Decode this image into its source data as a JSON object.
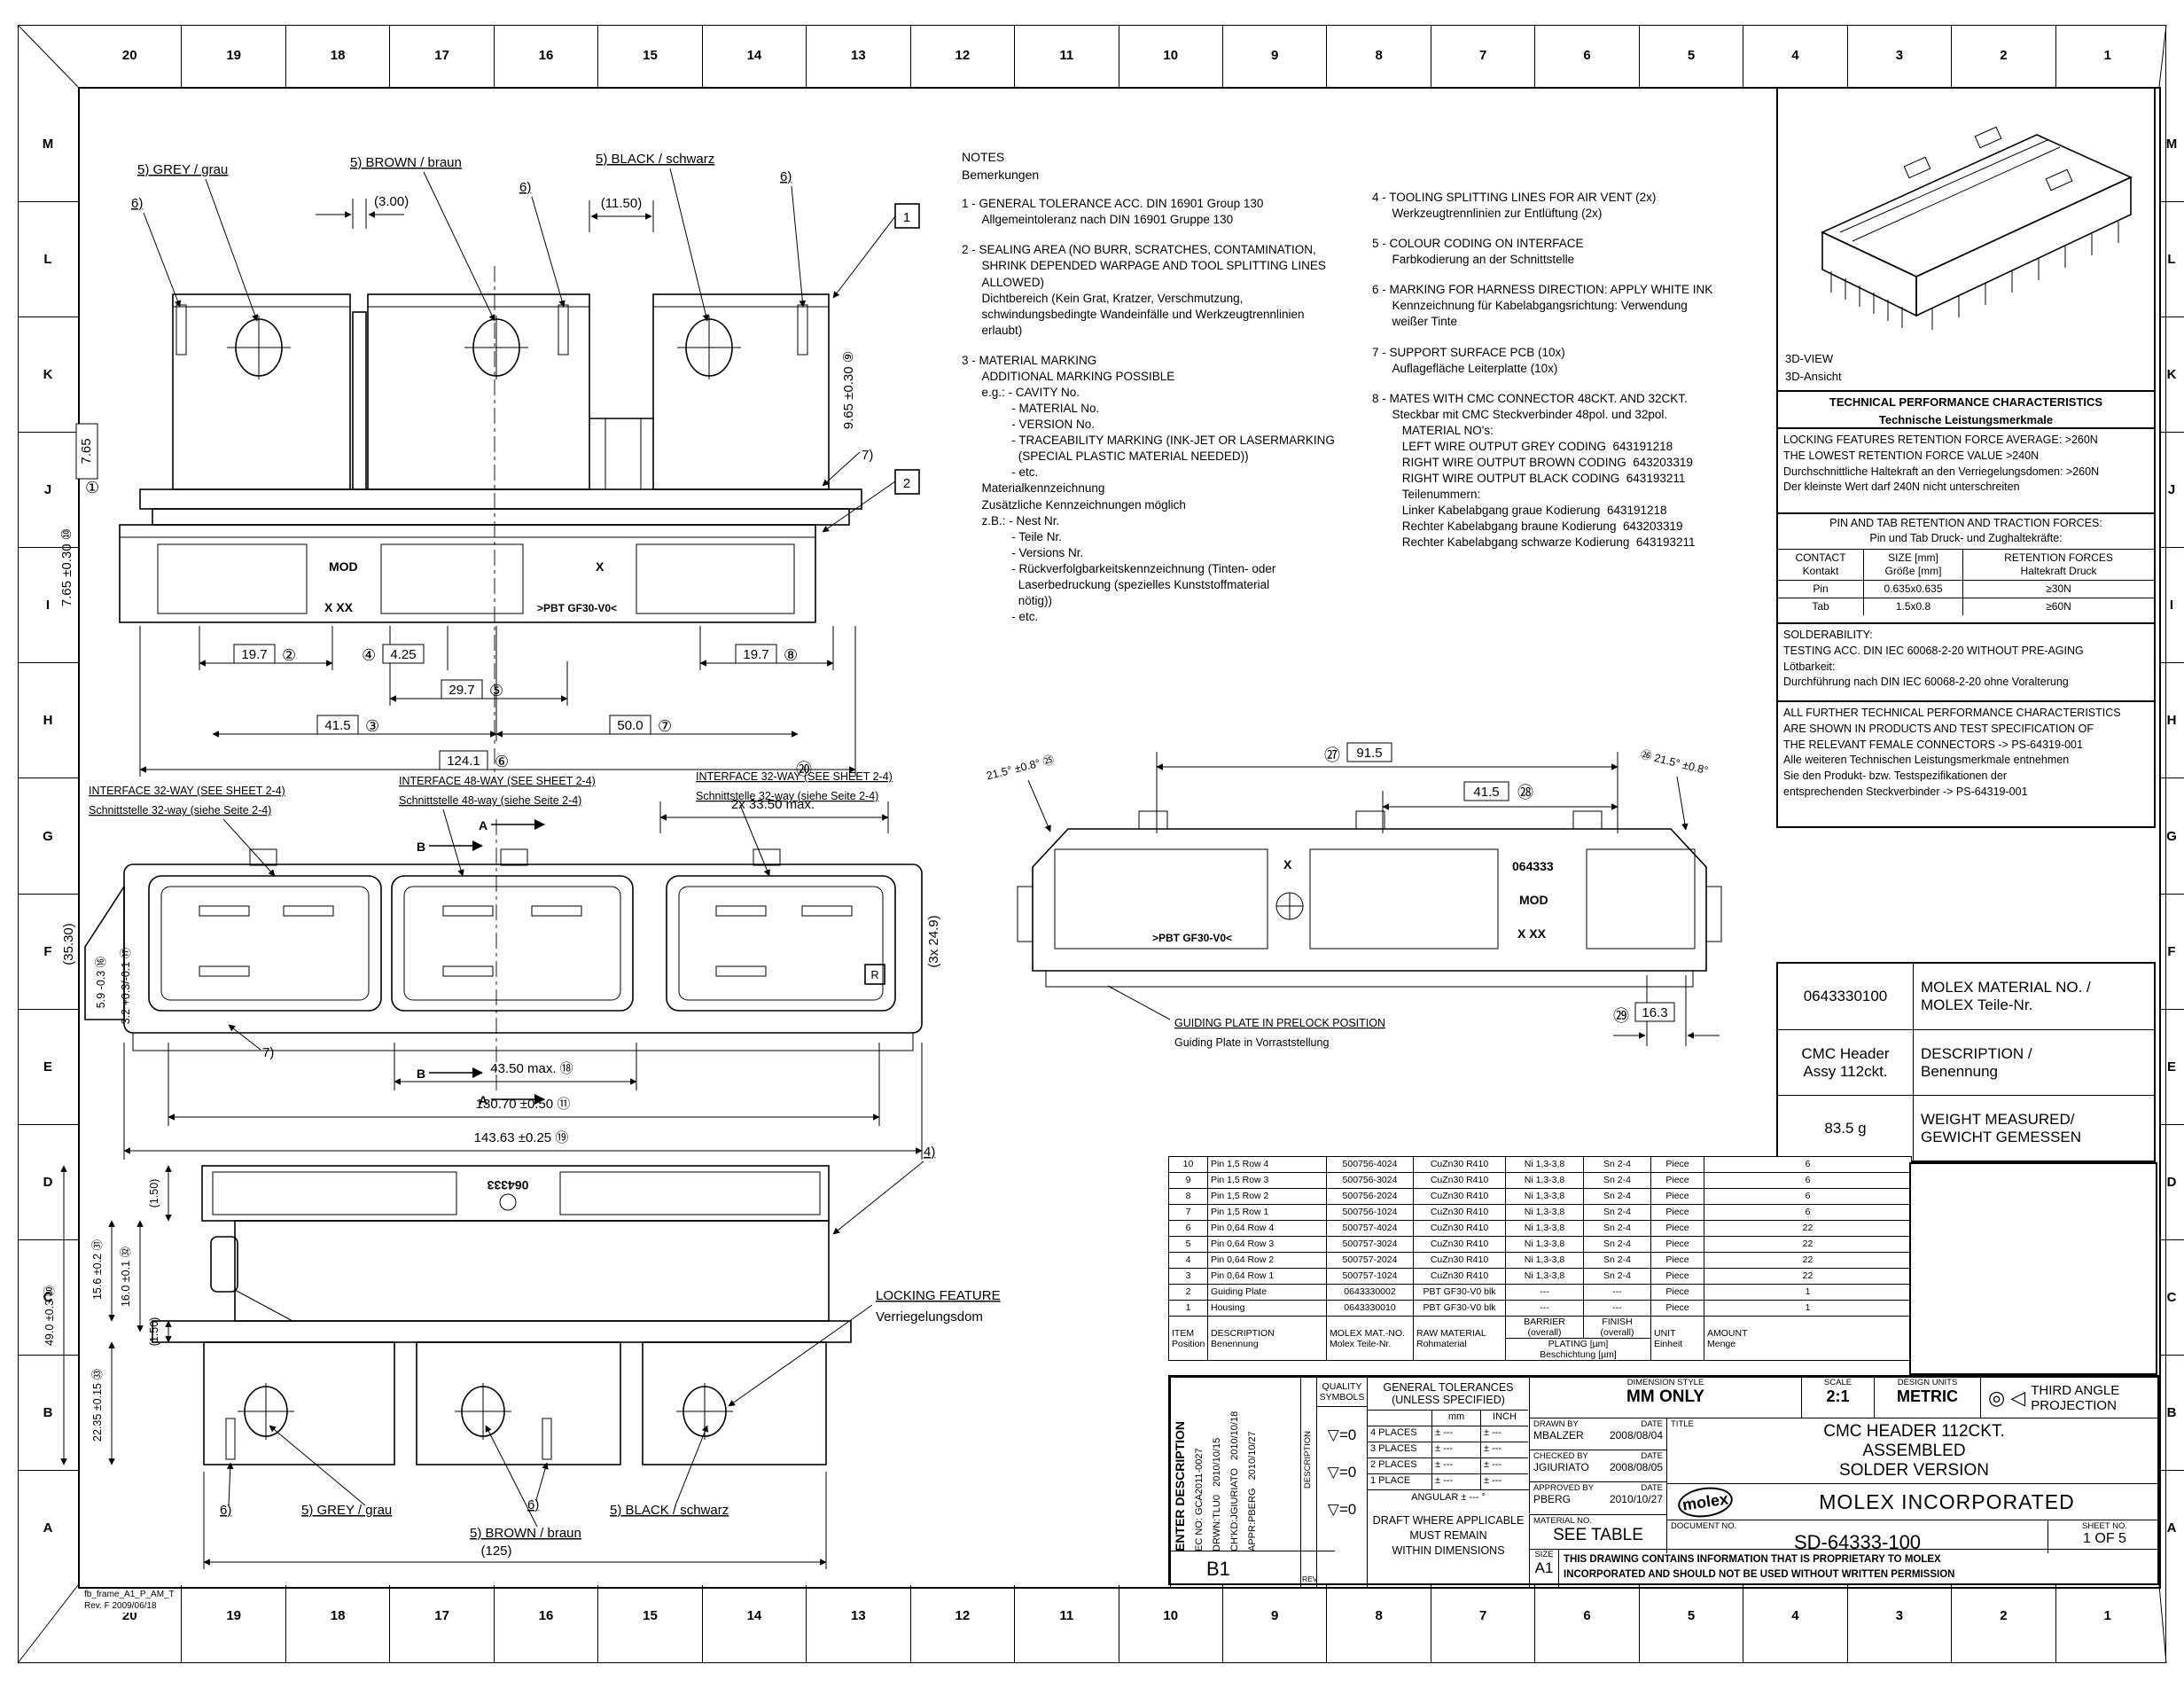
{
  "frame": {
    "cols": [
      "20",
      "19",
      "18",
      "17",
      "16",
      "15",
      "14",
      "13",
      "12",
      "11",
      "10",
      "9",
      "8",
      "7",
      "6",
      "5",
      "4",
      "3",
      "2",
      "1"
    ],
    "rows": [
      "M",
      "L",
      "K",
      "J",
      "I",
      "H",
      "G",
      "F",
      "E",
      "D",
      "C",
      "B",
      "A"
    ],
    "id": "fb_frame_A1_P_AM_T",
    "rev": "Rev. F 2009/06/18"
  },
  "notes": {
    "title": "NOTES\nBemerkungen",
    "n1": "1 - GENERAL TOLERANCE ACC. DIN 16901 Group 130\n      Allgemeintoleranz nach DIN 16901 Gruppe 130",
    "n2": "2 - SEALING AREA (NO BURR, SCRATCHES, CONTAMINATION,\n      SHRINK DEPENDED WARPAGE AND TOOL SPLITTING LINES\n      ALLOWED)\n      Dichtbereich (Kein Grat, Kratzer, Verschmutzung,\n      schwindungsbedingte Wandeinfälle und Werkzeugtrennlinien\n      erlaubt)",
    "n3": "3 - MATERIAL MARKING\n      ADDITIONAL MARKING POSSIBLE\n      e.g.: - CAVITY No.\n               - MATERIAL No.\n               - VERSION No.\n               - TRACEABILITY MARKING (INK-JET OR LASERMARKING\n                 (SPECIAL PLASTIC MATERIAL NEEDED))\n               - etc.\n      Materialkennzeichnung\n      Zusätzliche Kennzeichnungen möglich\n      z.B.: - Nest Nr.\n               - Teile Nr.\n               - Versions Nr.\n               - Rückverfolgbarkeitskennzeichnung (Tinten- oder\n                 Laserbedruckung (spezielles Kunststoffmaterial\n                 nötig))\n               - etc.",
    "n4": "4 - TOOLING SPLITTING LINES FOR AIR VENT (2x)\n      Werkzeugtrennlinien zur Entlüftung (2x)",
    "n5": "5 - COLOUR CODING ON INTERFACE\n      Farbkodierung an der Schnittstelle",
    "n6": "6 - MARKING FOR HARNESS DIRECTION: APPLY WHITE INK\n      Kennzeichnung für Kabelabgangsrichtung: Verwendung\n      weißer Tinte",
    "n7": "7 - SUPPORT SURFACE PCB (10x)\n      Auflagefläche Leiterplatte (10x)",
    "n8": "8 - MATES WITH CMC CONNECTOR 48CKT. AND 32CKT.\n      Steckbar mit CMC Steckverbinder 48pol. und 32pol.\n         MATERIAL NO's:\n         LEFT WIRE OUTPUT GREY CODING  643191218\n         RIGHT WIRE OUTPUT BROWN CODING  643203319\n         RIGHT WIRE OUTPUT BLACK CODING  643193211\n         Teilenummern:\n         Linker Kabelabgang graue Kodierung  643191218\n         Rechter Kabelabgang braune Kodierung  643203319\n         Rechter Kabelabgang schwarze Kodierung  643193211"
  },
  "panel": {
    "view3d": "3D-VIEW\n3D-Ansicht",
    "tech_title": "TECHNICAL PERFORMANCE CHARACTERISTICS",
    "tech_title_de": "Technische Leistungsmerkmale",
    "locking": "LOCKING FEATURES RETENTION FORCE AVERAGE: >260N\nTHE LOWEST RETENTION FORCE VALUE >240N\nDurchschnittliche Haltekraft an den Verriegelungsdomen: >260N\nDer kleinste Wert darf 240N nicht unterschreiten",
    "pintab_title": "PIN AND TAB RETENTION AND TRACTION FORCES:\nPin und Tab Druck- und Zughaltekräfte:",
    "tbl": {
      "h1": "CONTACT\nKontakt",
      "h2": "SIZE [mm]\nGröße [mm]",
      "h3": "RETENTION FORCES\nHaltekraft Druck",
      "r1": [
        "Pin",
        "0.635x0.635",
        "≥30N"
      ],
      "r2": [
        "Tab",
        "1.5x0.8",
        "≥60N"
      ]
    },
    "solder": "SOLDERABILITY:\nTESTING ACC. DIN IEC 60068-2-20 WITHOUT PRE-AGING\nLötbarkeit:\nDurchführung nach DIN IEC 60068-2-20 ohne Voralterung",
    "further": "ALL FURTHER TECHNICAL PERFORMANCE CHARACTERISTICS\nARE SHOWN IN PRODUCTS AND TEST SPECIFICATION OF\nTHE RELEVANT FEMALE CONNECTORS -> PS-64319-001\nAlle weiteren Technischen Leistungsmerkmale entnehmen\nSie den Produkt- bzw. Testspezifikationen der\nentsprechenden Steckverbinder -> PS-64319-001"
  },
  "mat": {
    "no": "0643330100",
    "no_l": "MOLEX MATERIAL NO. /\nMOLEX Teile-Nr.",
    "desc": "CMC Header\nAssy 112ckt.",
    "desc_l": "DESCRIPTION /\nBenennung",
    "wt": "83.5 g",
    "wt_l": "WEIGHT MEASURED/\nGEWICHT GEMESSEN"
  },
  "bom": {
    "rows": [
      [
        "10",
        "Pin 1,5 Row 4",
        "500756-4024",
        "CuZn30 R410",
        "Ni 1,3-3,8",
        "Sn 2-4",
        "Piece",
        "6"
      ],
      [
        "9",
        "Pin 1,5 Row 3",
        "500756-3024",
        "CuZn30 R410",
        "Ni 1,3-3,8",
        "Sn 2-4",
        "Piece",
        "6"
      ],
      [
        "8",
        "Pin 1,5 Row 2",
        "500756-2024",
        "CuZn30 R410",
        "Ni 1,3-3,8",
        "Sn 2-4",
        "Piece",
        "6"
      ],
      [
        "7",
        "Pin 1,5 Row 1",
        "500756-1024",
        "CuZn30 R410",
        "Ni 1,3-3,8",
        "Sn 2-4",
        "Piece",
        "6"
      ],
      [
        "6",
        "Pin 0,64 Row 4",
        "500757-4024",
        "CuZn30 R410",
        "Ni 1,3-3,8",
        "Sn 2-4",
        "Piece",
        "22"
      ],
      [
        "5",
        "Pin 0,64 Row 3",
        "500757-3024",
        "CuZn30 R410",
        "Ni 1,3-3,8",
        "Sn 2-4",
        "Piece",
        "22"
      ],
      [
        "4",
        "Pin 0,64 Row 2",
        "500757-2024",
        "CuZn30 R410",
        "Ni 1,3-3,8",
        "Sn 2-4",
        "Piece",
        "22"
      ],
      [
        "3",
        "Pin 0,64 Row 1",
        "500757-1024",
        "CuZn30 R410",
        "Ni 1,3-3,8",
        "Sn 2-4",
        "Piece",
        "22"
      ],
      [
        "2",
        "Guiding Plate",
        "0643330002",
        "PBT GF30-V0 blk",
        "---",
        "---",
        "Piece",
        "1"
      ],
      [
        "1",
        "Housing",
        "0643330010",
        "PBT GF30-V0 blk",
        "---",
        "---",
        "Piece",
        "1"
      ]
    ],
    "h": {
      "item": "ITEM\nPosition",
      "desc": "DESCRIPTION\nBenennung",
      "mat": "MOLEX MAT.-NO.\nMolex Teile-Nr.",
      "raw": "RAW MATERIAL\nRohmaterial",
      "barrier": "BARRIER (overall)",
      "finish": "FINISH (overall)",
      "plating": "PLATING [µm]\nBeschichtung [µm]",
      "unit": "UNIT\nEinheit",
      "amount": "AMOUNT\nMenge"
    }
  },
  "tb": {
    "rev_cols": [
      "ENTER DESCRIPTION",
      "EC NO: GCA2011-0027",
      "DRWN:TLU0   2010/10/15",
      "CH'KD:JGIURIATO   2010/10/18",
      "APPR:PBERG   2010/10/27"
    ],
    "b1": "B1",
    "rev": "REV",
    "desc": "DESCRIPTION",
    "quality": "QUALITY\nSYMBOLS",
    "qsyms": [
      "▽=0",
      "▽=0",
      "▽=0"
    ],
    "tol_hdr": "GENERAL TOLERANCES\n(UNLESS SPECIFIED)",
    "mm": "mm",
    "inch": "INCH",
    "tol_rows": [
      "4 PLACES",
      "3 PLACES",
      "2 PLACES",
      "1 PLACE"
    ],
    "pm": "± ---",
    "angular": "ANGULAR ± --- °",
    "draft": "DRAFT WHERE APPLICABLE\nMUST REMAIN\nWITHIN DIMENSIONS",
    "dimstyle_l": "DIMENSION STYLE",
    "dimstyle": "MM ONLY",
    "scale_l": "SCALE",
    "scale": "2:1",
    "units_l": "DESIGN UNITS",
    "units": "METRIC",
    "proj_glyph": "◎ ◁",
    "proj": "THIRD ANGLE\nPROJECTION",
    "drawn_l": "DRAWN BY",
    "date_l": "DATE",
    "drawn": "MBALZER",
    "drawn_d": "2008/08/04",
    "checked_l": "CHECKED BY",
    "checked": "JGIURIATO",
    "checked_d": "2008/08/05",
    "approved_l": "APPROVED BY",
    "approved": "PBERG",
    "approved_d": "2010/10/27",
    "matno_l": "MATERIAL NO.",
    "matno": "SEE TABLE",
    "size_l": "SIZE",
    "size": "A1",
    "title_l": "TITLE",
    "title": "CMC HEADER 112CKT.\nASSEMBLED\nSOLDER VERSION",
    "logo": "molex",
    "company": "MOLEX INCORPORATED",
    "doc_l": "DOCUMENT NO.",
    "doc": "SD-64333-100",
    "sheet_l": "SHEET NO.",
    "sheet": "1 OF 5",
    "discl": "THIS DRAWING CONTAINS INFORMATION THAT IS PROPRIETARY TO MOLEX\nINCORPORATED AND SHOULD NOT BE USED WITHOUT WRITTEN PERMISSION"
  },
  "views": {
    "v1": {
      "grey": "5) GREY / grau",
      "brown": "5) BROWN / braun",
      "black": "5) BLACK / schwarz",
      "n6": "6)",
      "n7": "7)",
      "d300": "(3.00)",
      "d1150": "(11.50)",
      "box1": "1",
      "box2": "2",
      "b1": "①",
      "d765": "7.65",
      "d765t": "7.65 ±0.30 ⑩",
      "d965": "9.65 ±0.30 ⑨",
      "mod": "MOD",
      "x": "X",
      "xxx": "X XX",
      "pbt": ">PBT GF30-V0<",
      "d197a": "19.7",
      "b2": "②",
      "b4": "④",
      "d425": "4.25",
      "d297": "29.7",
      "b5": "⑤",
      "d415": "41.5",
      "b3": "③",
      "d500": "50.0",
      "b7": "⑦",
      "d197b": "19.7",
      "b8": "⑧",
      "d1241": "124.1",
      "b6": "⑥"
    },
    "v3": {
      "if32": "INTERFACE 32-WAY (SEE SHEET 2-4)",
      "if32de": "Schnittstelle 32-way (siehe Seite 2-4)",
      "if48": "INTERFACE 48-WAY (SEE SHEET 2-4)",
      "if48de": "Schnittstelle 48-way (siehe Seite 2-4)",
      "secA": "A",
      "secB": "B",
      "b20": "⑳",
      "d3350": "2x  33.50  max.",
      "d3530": "(35.30)",
      "d59": "5.9 -0.3 ⑯",
      "d32": "3.2 +0.3/-0.1 ⑰",
      "d249": "(3x  24.9)",
      "n7": "7)",
      "r": "R",
      "d4350": "43.50  max. ⑱",
      "d13070": "130.70 ±0.50 ⑪",
      "d14363": "143.63 ±0.25 ⑲"
    },
    "v4": {
      "b27": "㉗",
      "d915": "91.5",
      "d415": "41.5",
      "b28": "㉘",
      "angL": "21.5° ±0.8° ㉕",
      "angR": "㉖ 21.5° ±0.8°",
      "gp1": "GUIDING PLATE IN PRELOCK POSITION",
      "gp2": "Guiding Plate in Vorraststellung",
      "b29": "㉙",
      "d163": "16.3",
      "x": "X",
      "num": "064333",
      "mod": "MOD",
      "xxx": "X XX",
      "pbt": ">PBT GF30-V0<"
    },
    "v5": {
      "d150a": "(1.50)",
      "d156": "15.6 ±0.2 ㉛",
      "d160": "16.0 ±0.1 ㉜",
      "d490": "49.0 ±0.3 ㉚",
      "d150b": "(1.50)",
      "d2235": "22.35 ±0.15 ㉝",
      "n4": "4)",
      "lock1": "LOCKING FEATURE",
      "lock2": "Verriegelungsdom",
      "n6a": "6)",
      "n6b": "6)",
      "grey": "5) GREY / grau",
      "brown": "5) BROWN / braun",
      "black": "5) BLACK / schwarz",
      "d125": "(125)",
      "num": "064333"
    }
  }
}
